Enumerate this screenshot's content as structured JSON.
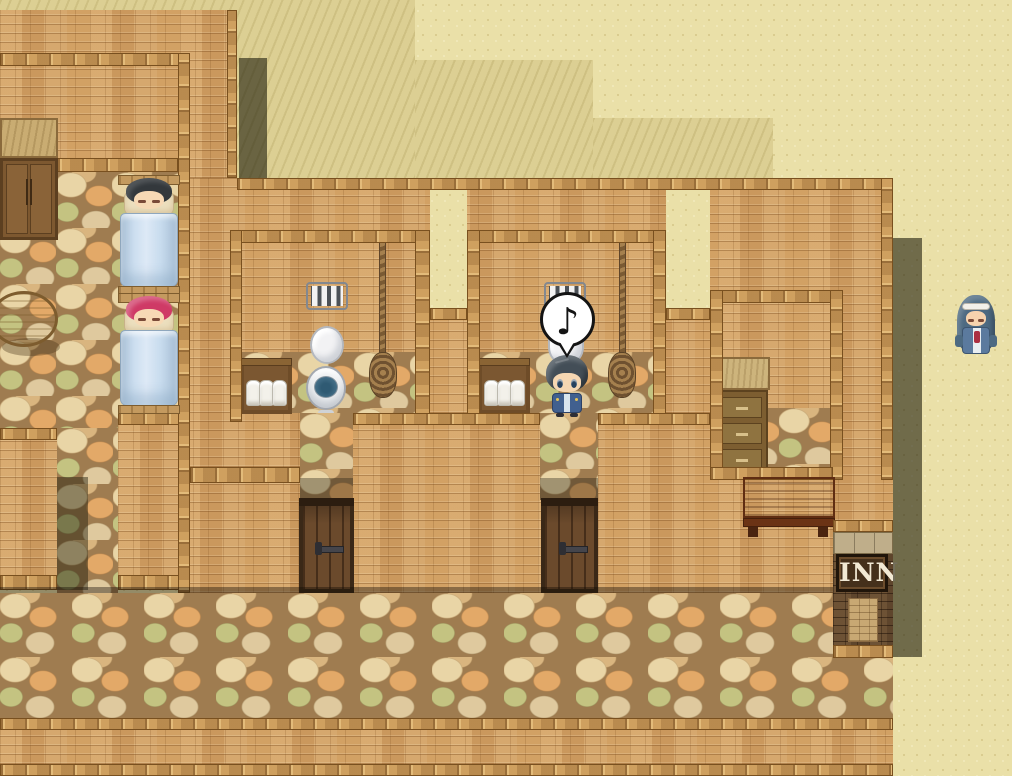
{
  "scene": {
    "title": "Desert Inn — Interior (top-down pixel RPG scene)",
    "sign": {
      "text": "INN"
    },
    "speech_bubble": {
      "symbol": "♪",
      "meaning": "music note above the hero at the toilet stall"
    },
    "characters": {
      "sleeper_top": {
        "name": "sleeping guest with dark hair",
        "state": "asleep in upper bed",
        "hair_color": "#33383c"
      },
      "sleeper_bottom": {
        "name": "sleeping guest with pink hair",
        "state": "asleep in lower bed",
        "hair_color": "#cf3a66"
      },
      "player": {
        "name": "blue-haired hero",
        "state": "standing at toilet stall, singing"
      },
      "npc": {
        "name": "priestess with long blue hair and white headband",
        "state": "standing outside on the sand"
      }
    },
    "objects": {
      "wardrobe": "wooden wardrobe",
      "round_table": "round wooden table",
      "beds": "two beds with light-blue blankets",
      "toilets": "two white toilets in stalls",
      "toilet_paper": "wooden crates with white paper rolls",
      "windows": "small barred stall windows",
      "ropes": "hanging pull-ropes with coiled ends",
      "dresser": "chest of drawers",
      "desk": "reddish wooden desk",
      "doors": "two dark wooden doors",
      "inn_sign": "INN sign on dark brick pillar"
    },
    "palette": {
      "sand_light": "#eae0a8",
      "sand_dark": "#dccf93",
      "brick_wall": "#d2a164",
      "wood_beam": "#cfa05f",
      "cobblestone": "#c9a871",
      "shadow": "rgba(30,28,12,0.6)",
      "blanket_blue": "#c5d8ea",
      "door_wood": "#6b4a2c",
      "sign_board": "#45301b",
      "sign_text": "#f2e9d4",
      "desk_wood": "#a85726",
      "toilet_water": "#46718a"
    }
  }
}
